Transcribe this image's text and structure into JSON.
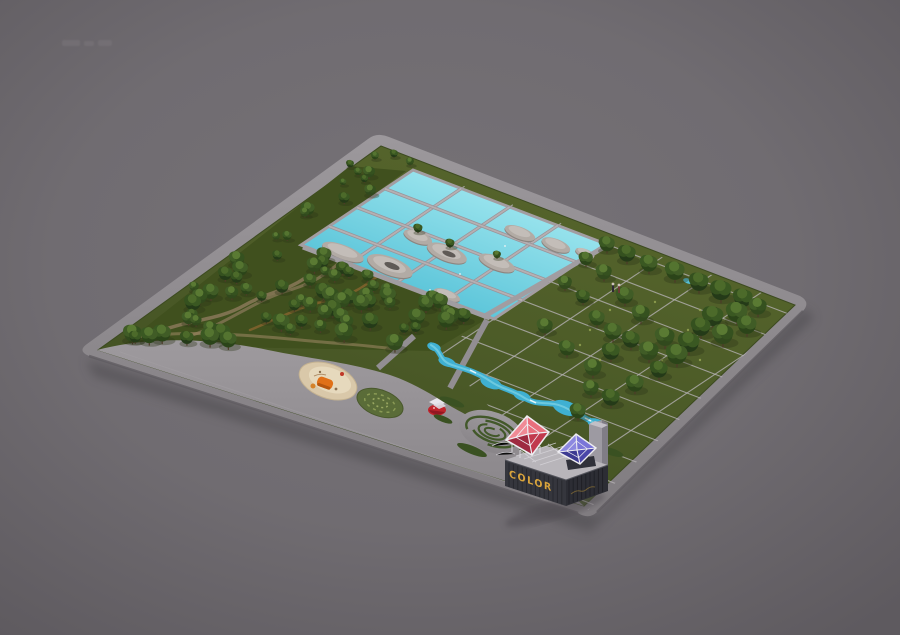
{
  "scene": {
    "description": "Aerial isometric 3D render of a rectangular park master plan floating on a muted gray background",
    "background": {
      "center": "#767277",
      "edge": "#5e5a5f"
    },
    "signage": {
      "building_sign": "COLOR",
      "sign_color": "#d9a43c"
    },
    "people_count": 2,
    "pool_grid": {
      "rows": 4,
      "cols": 4
    },
    "palette": {
      "road": "#918d91",
      "plaza": "#938f93",
      "grass": "#4b5a2b",
      "forest_floor": "#40501e",
      "pool_water": "#7fd6e2",
      "pool_walkway": "#a89fa3",
      "island_stone": "#b2aba5",
      "stream": "#3fb0d2",
      "sand": "#d9c8a9",
      "play_orange": "#e07018",
      "pavilion_red": "#c0242c",
      "pyramid_red": "#d84a5c",
      "pyramid_blue": "#5a55c8",
      "building_dark": "#35363d",
      "frame_white": "#eeedf1",
      "tree_green": "#35511f"
    },
    "features": [
      {
        "name": "pool-grid",
        "label": "reflecting pool grid with stone islands"
      },
      {
        "name": "forest-grove",
        "label": "dense grove with winding trails"
      },
      {
        "name": "lawn-grid",
        "label": "lawn with woven path grid"
      },
      {
        "name": "promenade",
        "label": "south promenade plaza"
      },
      {
        "name": "playground",
        "label": "sand playground with orange equipment"
      },
      {
        "name": "hedge-circle",
        "label": "planted dotted circle"
      },
      {
        "name": "red-pavilion",
        "label": "red canopy pavilion"
      },
      {
        "name": "spiral-garden",
        "label": "spiral hedge garden"
      },
      {
        "name": "stream",
        "label": "winding stream with ponds"
      },
      {
        "name": "color-pavilion",
        "label": "dark container pavilion with red and blue glass pyramids"
      }
    ]
  }
}
